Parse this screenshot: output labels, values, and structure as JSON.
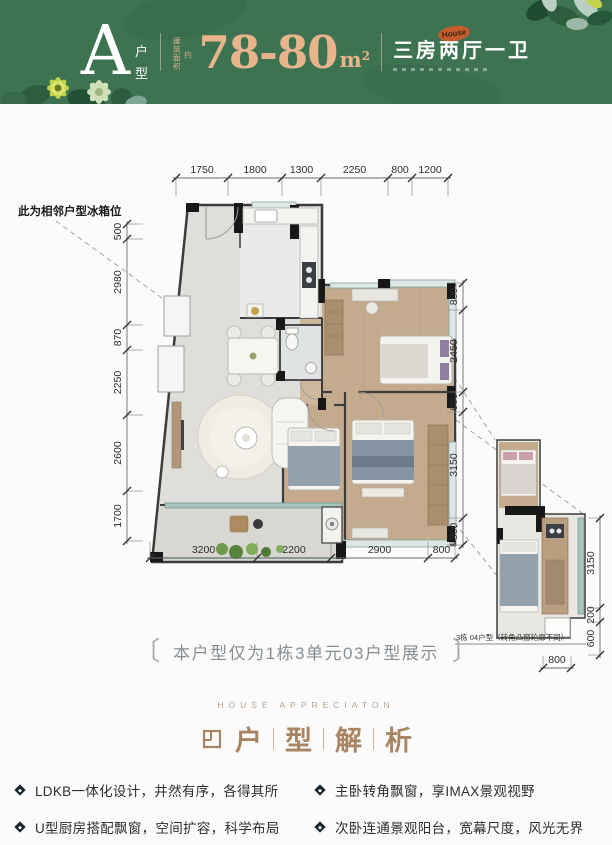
{
  "header": {
    "unit_letter": "A",
    "unit_label_top": "户",
    "unit_label_bottom": "型",
    "area_prefix": "建筑面积",
    "area_prefix2": "约",
    "area_value": "78-80",
    "area_unit": "m",
    "area_exponent": "2",
    "layout_text": "三房两厅一卫",
    "stamp_text": "House"
  },
  "plan": {
    "fridge_note": "此为相邻户型冰箱位",
    "display_note": "本户型仅为1栋3单元03户型展示",
    "note_bracket_left": "〔",
    "note_bracket_right": "〕",
    "inset_caption": "3栋 04户型（转角凸窗轮廓不同）",
    "dims_top": [
      "1750",
      "1800",
      "1300",
      "2250",
      "800",
      "1200"
    ],
    "dims_left": [
      "500",
      "2980",
      "870",
      "2250",
      "2600",
      "1700"
    ],
    "dims_right": [
      "800",
      "2450",
      "600",
      "3150",
      "800"
    ],
    "dims_bottom": [
      "3200",
      "2200",
      "2900",
      "800"
    ],
    "dims_inset_right": [
      "3150",
      "200",
      "600"
    ],
    "dims_inset_bottom": [
      "800"
    ]
  },
  "section": {
    "eyebrow": "HOUSE APPRECIATON",
    "title_chars": [
      "户",
      "型",
      "解",
      "析"
    ]
  },
  "features": [
    {
      "text": "LDKB一体化设计，井然有序，各得其所"
    },
    {
      "text": "主卧转角飘窗，享IMAX景观视野"
    },
    {
      "text": "U型厨房搭配飘窗，空间扩容，科学布局"
    },
    {
      "text": "次卧连通景观阳台，宽幕尺度，风光无界"
    }
  ],
  "colors": {
    "header_green": "#3e7352",
    "accent_rose": "#e8b48c",
    "section_tan": "#a98463",
    "wall_dark": "#3c3c3c",
    "wood_floor": "#c4ab8e",
    "glass_teal": "#a7c4bd",
    "bullet_dark": "#182830"
  }
}
